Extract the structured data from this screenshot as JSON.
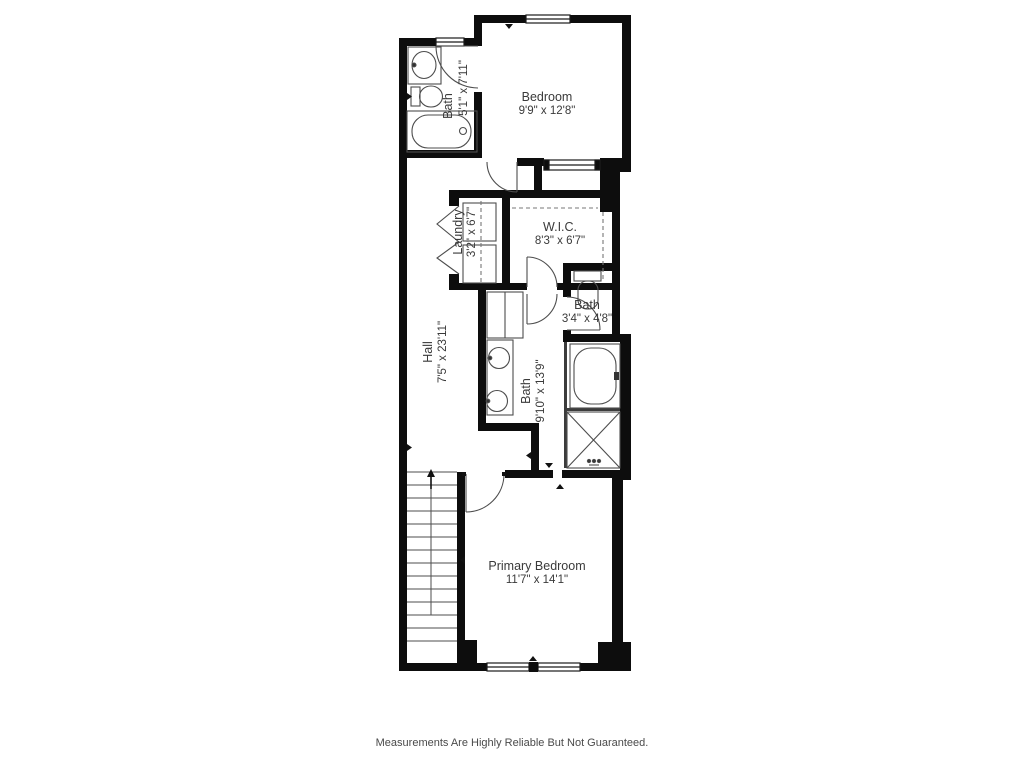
{
  "floor_plan": {
    "rooms": [
      {
        "id": "bath-upper",
        "name": "Bath",
        "dims": "5'1\" x 7'11\""
      },
      {
        "id": "bedroom",
        "name": "Bedroom",
        "dims": "9'9\" x 12'8\""
      },
      {
        "id": "laundry",
        "name": "Laundry",
        "dims": "3'2\" x 6'7\""
      },
      {
        "id": "wic",
        "name": "W.I.C.",
        "dims": "8'3\" x 6'7\""
      },
      {
        "id": "bath-small",
        "name": "Bath",
        "dims": "3'4\" x 4'8\""
      },
      {
        "id": "hall",
        "name": "Hall",
        "dims": "7'5\" x 23'11\""
      },
      {
        "id": "bath-primary",
        "name": "Bath",
        "dims": "9'10\" x 13'9\""
      },
      {
        "id": "primary-bedroom",
        "name": "Primary Bedroom",
        "dims": "11'7\" x 14'1\""
      }
    ],
    "colors": {
      "wall": "#0d0d0d",
      "background": "#ffffff",
      "fixture_line": "#4d4d4d",
      "label": "#3a3a3a"
    },
    "footer": {
      "disclaimer": "Measurements Are Highly Reliable But Not Guaranteed."
    }
  }
}
